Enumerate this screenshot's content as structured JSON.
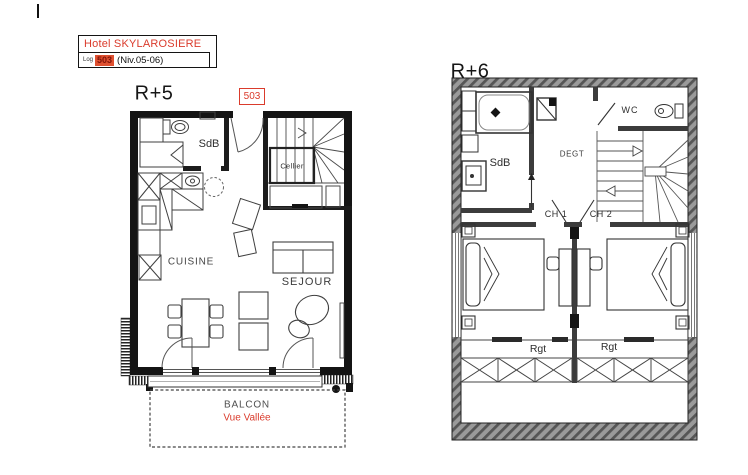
{
  "page": {
    "background": "#ffffff"
  },
  "colors": {
    "accent_red": "#da3b2c",
    "chip_bg": "#df5030",
    "chip_text": "#801409",
    "wall_black": "#141414",
    "hatch_gray": "#9a9a9a",
    "label_gray": "#3a3a3a"
  },
  "title_block": {
    "hotel_name": "Hotel SKYLAROSIERE",
    "log_label": "Log",
    "unit_number": "503",
    "level_range": "(Niv.05-06)"
  },
  "floor_r5": {
    "floor_label": "R+5",
    "unit_badge": "503",
    "rooms": {
      "bathroom": "SdB",
      "cellar": "Cellier",
      "kitchen": "CUISINE",
      "living_room": "SEJOUR"
    },
    "balcony": {
      "name": "BALCON",
      "view": "Vue Vallée"
    }
  },
  "floor_r6": {
    "floor_label": "R+6",
    "rooms": {
      "bathroom": "SdB",
      "hallway": "DEGT",
      "wc": "WC",
      "bedroom_1": "CH 1",
      "bedroom_2": "CH 2",
      "storage_left": "Rgt",
      "storage_right": "Rgt"
    }
  }
}
